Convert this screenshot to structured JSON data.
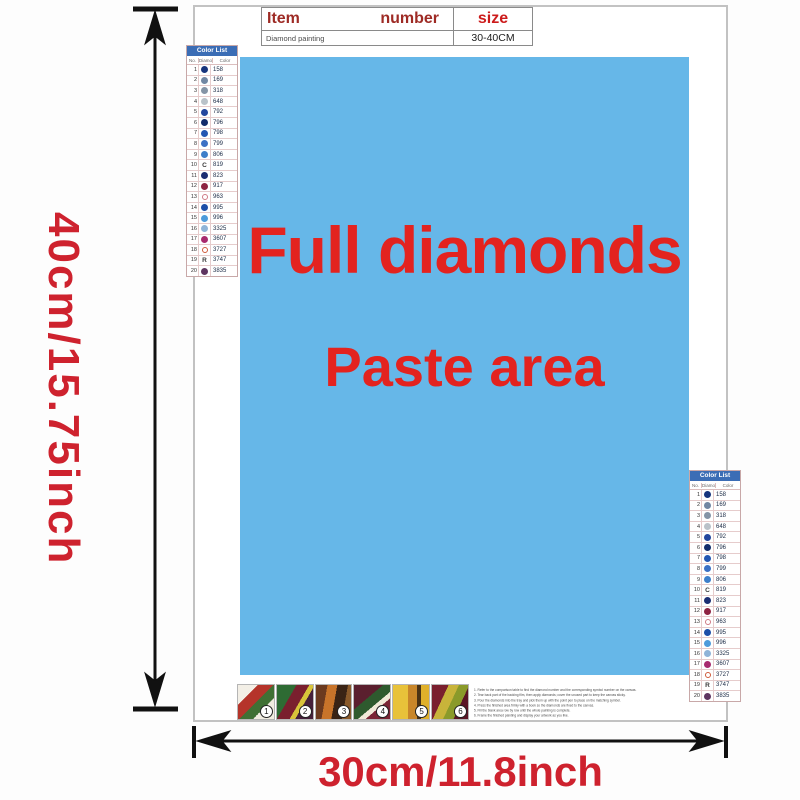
{
  "theme": {
    "paste_bg": "#66b7e8",
    "accent_red": "#e3231f",
    "dim_red": "#ce222e",
    "table_header_red": "#9e2b25",
    "size_red": "#cc1b1b",
    "list_header_bg": "#3b6db5",
    "list_header_text": "#ffffff"
  },
  "dimensions": {
    "height_label": "40cm/15.75inch",
    "width_label": "30cm/11.8inch"
  },
  "info_table": {
    "headers": {
      "item": "Item",
      "number": "number",
      "size": "size"
    },
    "row": {
      "name": "Diamond painting",
      "size": "30-40CM"
    }
  },
  "paste_area": {
    "line1": "Full diamonds",
    "line2": "Paste area"
  },
  "color_list": {
    "title": "Color List",
    "columns": [
      "No.",
      "Diamond",
      "Color"
    ],
    "rows": [
      {
        "no": "1",
        "symbol": "dot",
        "color": "#17357d",
        "code": "158"
      },
      {
        "no": "2",
        "symbol": "dot",
        "color": "#7187a3",
        "code": "169"
      },
      {
        "no": "3",
        "symbol": "dot",
        "color": "#8494a6",
        "code": "318"
      },
      {
        "no": "4",
        "symbol": "dot",
        "color": "#b9c2c9",
        "code": "648"
      },
      {
        "no": "5",
        "symbol": "dot",
        "color": "#24479e",
        "code": "792"
      },
      {
        "no": "6",
        "symbol": "dot",
        "color": "#122c6b",
        "code": "796"
      },
      {
        "no": "7",
        "symbol": "dot",
        "color": "#2356b2",
        "code": "798"
      },
      {
        "no": "8",
        "symbol": "dot",
        "color": "#3b70c4",
        "code": "799"
      },
      {
        "no": "9",
        "symbol": "dot",
        "color": "#3d7fca",
        "code": "806"
      },
      {
        "no": "10",
        "symbol": "letter",
        "letter": "C",
        "code": "819"
      },
      {
        "no": "11",
        "symbol": "dot",
        "color": "#1b2d72",
        "code": "823"
      },
      {
        "no": "12",
        "symbol": "dot",
        "color": "#8e2342",
        "code": "917"
      },
      {
        "no": "13",
        "symbol": "ring",
        "color": "#cf7a85",
        "code": "963"
      },
      {
        "no": "14",
        "symbol": "dot",
        "color": "#1d4fa8",
        "code": "995"
      },
      {
        "no": "15",
        "symbol": "dot",
        "color": "#4d9bdb",
        "code": "996"
      },
      {
        "no": "16",
        "symbol": "dot",
        "color": "#8fb4d8",
        "code": "3325"
      },
      {
        "no": "17",
        "symbol": "dot",
        "color": "#a82a6e",
        "code": "3607"
      },
      {
        "no": "18",
        "symbol": "ring",
        "color": "#cf5a3a",
        "code": "3727"
      },
      {
        "no": "19",
        "symbol": "letter",
        "letter": "R",
        "code": "3747"
      },
      {
        "no": "20",
        "symbol": "dot",
        "color": "#5e3560",
        "code": "3835"
      }
    ]
  },
  "steps": [
    {
      "number": "1"
    },
    {
      "number": "2"
    },
    {
      "number": "3"
    },
    {
      "number": "4"
    },
    {
      "number": "5"
    },
    {
      "number": "6"
    }
  ],
  "instructions": {
    "lines": [
      "1. Refer to the comparison table to find the diamond number and the corresponding symbol number on the canvas.",
      "2. Tear back part of the backing film, then apply diamonds; cover the unused part to keep the canvas sticky.",
      "3. Pour the diamonds into the tray and pick them up with the point pen to place on the matching symbol.",
      "4. Press the finished area firmly with a book so the diamonds are fixed to the canvas.",
      "5. Fill the blank area row by row until the whole painting is complete.",
      "6. Frame the finished painting and display your artwork as you like."
    ]
  }
}
